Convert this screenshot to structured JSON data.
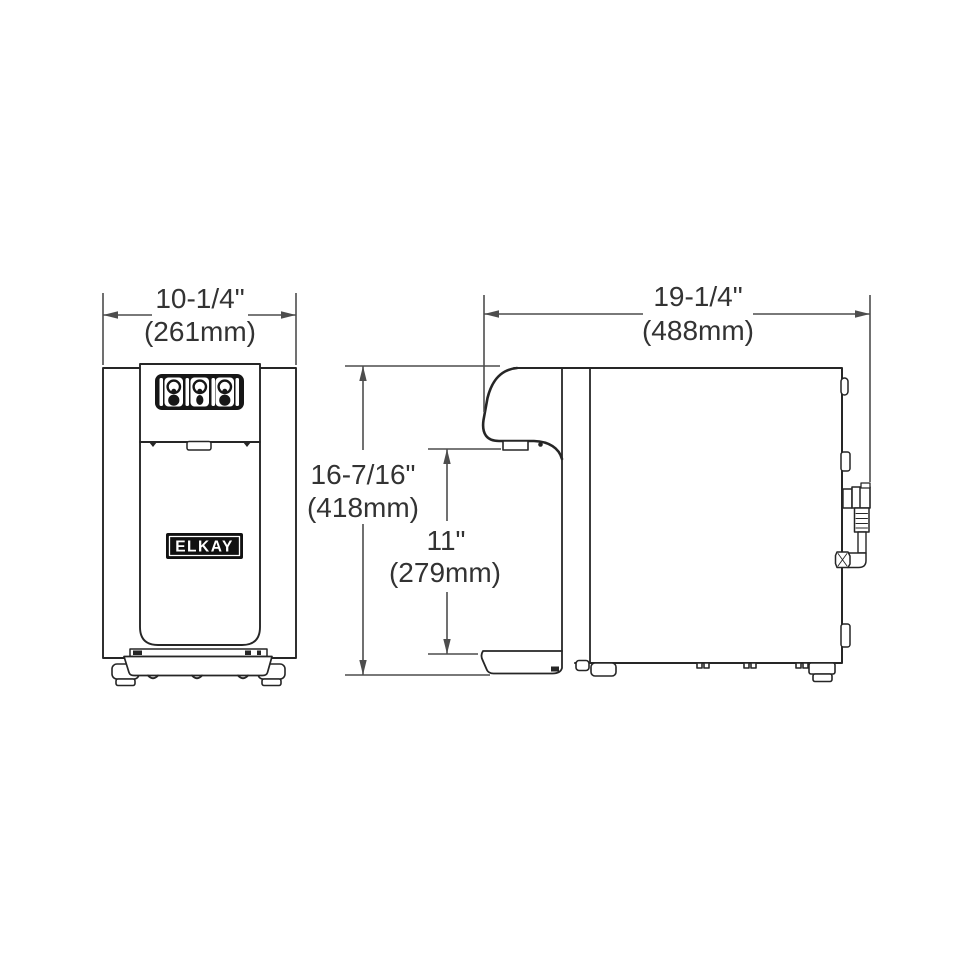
{
  "page": {
    "background": "#ffffff"
  },
  "drawing": {
    "brand_badge": "ELKAY",
    "dimensions": {
      "width": {
        "inches": "10-1/4\"",
        "metric": "(261mm)"
      },
      "depth": {
        "inches": "19-1/4\"",
        "metric": "(488mm)"
      },
      "height": {
        "inches": "16-7/16\"",
        "metric": "(418mm)"
      },
      "clearance": {
        "inches": "11\"",
        "metric": "(279mm)"
      }
    },
    "colors": {
      "object_line": "#262626",
      "dimension_line": "#4d4d4d",
      "label_text": "#333333",
      "panel_fill": "#161616"
    }
  }
}
